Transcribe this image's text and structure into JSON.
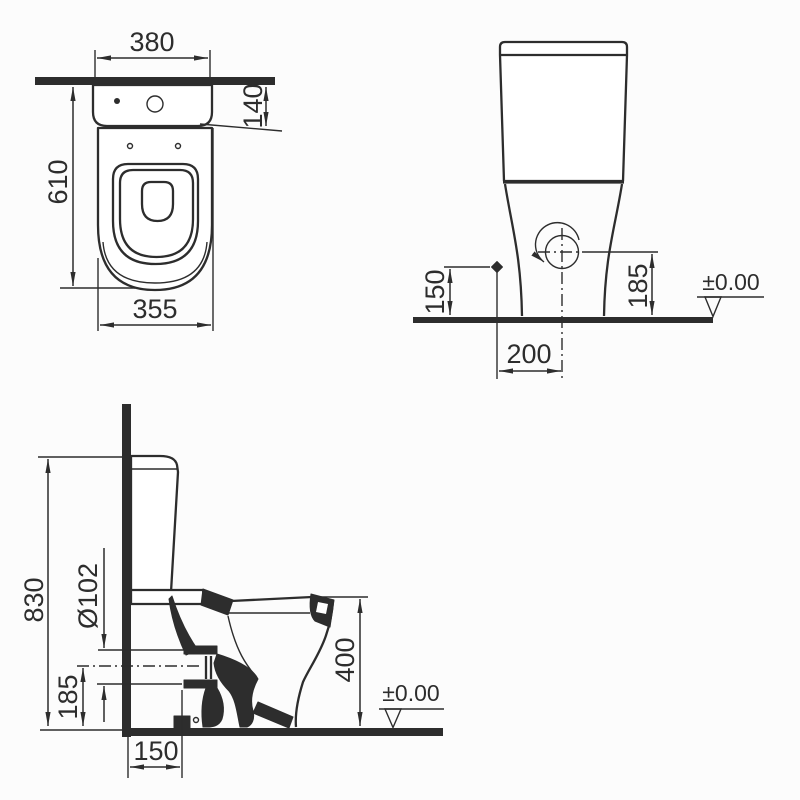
{
  "drawing_title": "toilet-three-view-dimension-drawing",
  "colors": {
    "line": "#2d2d2d",
    "background": "#fcfcfc"
  },
  "symbols": {
    "water_inlet": "diamond",
    "drain_rotation": "circle-with-crosshair-and-arc-arrow",
    "floor_datum": "open-triangle"
  },
  "views": {
    "plan": {
      "tank_width": "380",
      "tank_depth": "140",
      "total_depth": "610",
      "bowl_width": "355"
    },
    "front": {
      "inlet_height": "150",
      "outlet_center_height": "185",
      "outlet_offset": "200",
      "floor_datum": "±0.00"
    },
    "side": {
      "total_height": "830",
      "outlet_diameter": "Ø102",
      "outlet_center_height": "185",
      "bowl_height": "400",
      "outlet_wall_distance": "150",
      "floor_datum": "±0.00"
    }
  }
}
